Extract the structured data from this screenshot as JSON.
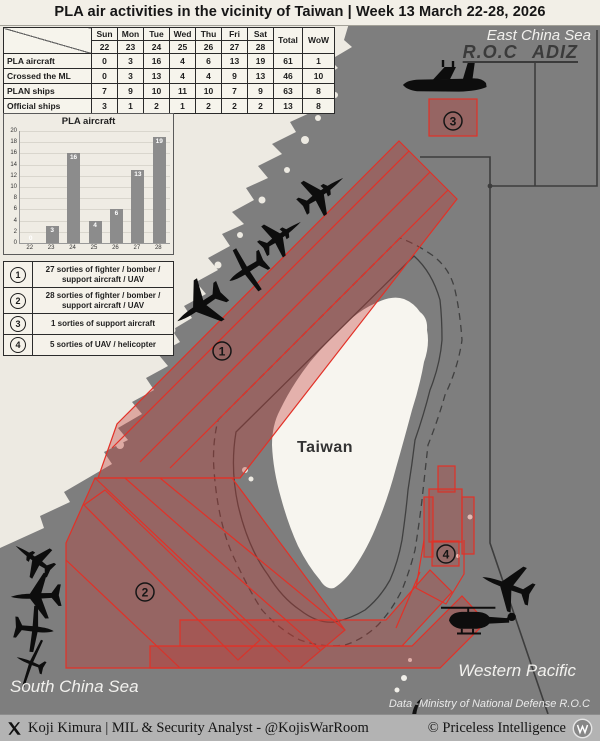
{
  "title": "PLA air activities in the vicinity of Taiwan | Week 13 March 22-28, 2026",
  "table": {
    "day_headers": [
      "Sun",
      "Mon",
      "Tue",
      "Wed",
      "Thu",
      "Fri",
      "Sat"
    ],
    "date_headers": [
      "22",
      "23",
      "24",
      "25",
      "26",
      "27",
      "28"
    ],
    "extra_headers": [
      "Total",
      "WoW"
    ],
    "rows": [
      {
        "label": "PLA aircraft",
        "values": [
          0,
          3,
          16,
          4,
          6,
          13,
          19
        ],
        "total": 61,
        "wow": 1
      },
      {
        "label": "Crossed the ML",
        "values": [
          0,
          3,
          13,
          4,
          4,
          9,
          13
        ],
        "total": 46,
        "wow": 10
      },
      {
        "label": "PLAN ships",
        "values": [
          7,
          9,
          10,
          11,
          10,
          7,
          9
        ],
        "total": 63,
        "wow": 8
      },
      {
        "label": "Official ships",
        "values": [
          3,
          1,
          2,
          1,
          2,
          2,
          2
        ],
        "total": 13,
        "wow": 8
      }
    ]
  },
  "chart_data": {
    "type": "bar",
    "title": "PLA aircraft",
    "categories": [
      "22",
      "23",
      "24",
      "25",
      "26",
      "27",
      "28"
    ],
    "values": [
      0,
      3,
      16,
      4,
      6,
      13,
      19
    ],
    "xlabel": "",
    "ylabel": "",
    "ylim": [
      0,
      20
    ],
    "ytick_step": 2,
    "grid": true,
    "legend_position": "none",
    "bar_color": "#8c8c8c"
  },
  "legend": {
    "items": [
      {
        "number": "1",
        "text": "27 sorties of fighter / bomber / support aircraft / UAV"
      },
      {
        "number": "2",
        "text": "28 sorties of fighter / bomber / support aircraft / UAV"
      },
      {
        "number": "3",
        "text": "1 sorties of support aircraft"
      },
      {
        "number": "4",
        "text": "5 sorties of UAV / helicopter"
      }
    ]
  },
  "map": {
    "labels": {
      "east_china_sea": "East China Sea",
      "roc_adiz": "R.O.C ADIZ",
      "taiwan": "Taiwan",
      "western_pacific": "Western Pacific",
      "south_china_sea": "South China Sea",
      "data_source": "Data -Ministry of National Defense R.O.C"
    },
    "zone_markers": [
      "1",
      "2",
      "3",
      "4"
    ],
    "colors": {
      "sea": "#7e7e7e",
      "land": "#edeae2",
      "taiwan": "#f7f5ef",
      "zone_fill": "rgba(195,58,52,0.36)",
      "zone_stroke": "#e23127",
      "adiz_line": "#3d3d3d",
      "contour": "#404040"
    }
  },
  "footer": {
    "left": "Koji Kimura | MIL & Security Analyst - @KojisWarRoom",
    "right": "© Priceless Intelligence"
  }
}
